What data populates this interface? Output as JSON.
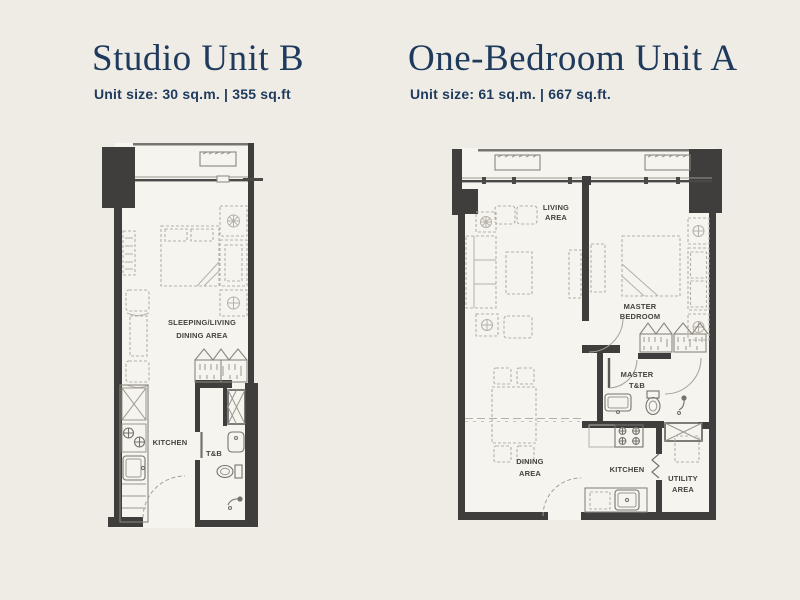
{
  "page": {
    "background_color": "#efece5",
    "accent_color": "#1e3a5c",
    "wall_color": "#3f3e3c",
    "floor_color": "#f6f4ef",
    "furniture_color": "#b5b1a8",
    "room_label_color": "#44433e"
  },
  "units": [
    {
      "id": "studio-unit-b",
      "title": "Studio Unit B",
      "subtitle": "Unit size: 30 sq.m. | 355 sq.ft",
      "area_sqm": "30 sq.m.",
      "area_sqft": "355 sq.ft",
      "room_labels": {
        "main_1": "SLEEPING/LIVING",
        "main_2": "DINING AREA",
        "kitchen": "KITCHEN",
        "bath": "T&B"
      }
    },
    {
      "id": "one-bedroom-unit-a",
      "title": "One-Bedroom Unit A",
      "subtitle": "Unit size: 61 sq.m. | 667 sq.ft.",
      "area_sqm": "61 sq.m.",
      "area_sqft": "667 sq.ft.",
      "room_labels": {
        "living_1": "LIVING",
        "living_2": "AREA",
        "bedroom_1": "MASTER",
        "bedroom_2": "BEDROOM",
        "bath_1": "MASTER",
        "bath_2": "T&B",
        "dining_1": "DINING",
        "dining_2": "AREA",
        "kitchen": "KITCHEN",
        "utility_1": "UTILITY",
        "utility_2": "AREA"
      }
    }
  ]
}
